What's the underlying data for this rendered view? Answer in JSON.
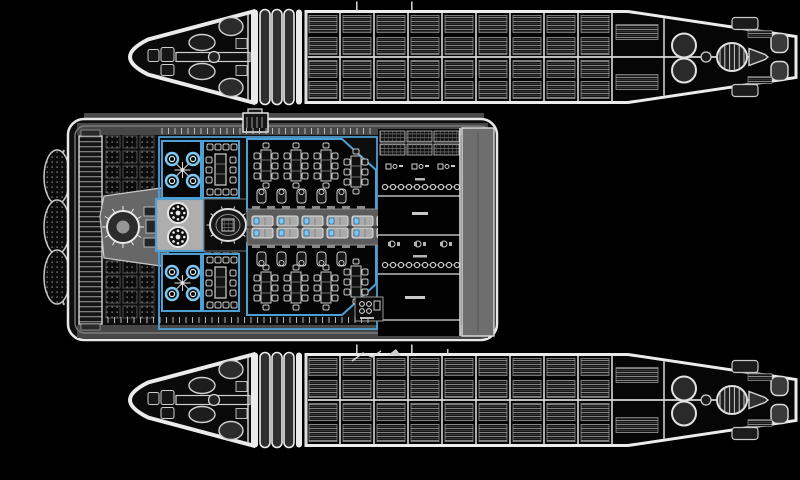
{
  "canvas": {
    "width": 800,
    "height": 480,
    "background": "#000000"
  },
  "palette": {
    "hull": "#ebebeb",
    "hull_fill": "#0a0a0a",
    "panel_gray": "#6e6e6e",
    "walkway_gray": "#474747",
    "light_gray": "#ababab",
    "line_gray": "#c9c9c9",
    "room_black": "#050505",
    "blue": "#4e9fd4",
    "blue_bright": "#7ec8f2",
    "blue_dark": "#2d6c96"
  },
  "ship": {
    "outriggers": {
      "count": 2,
      "bellows_rings": 3,
      "frame_lines": 10,
      "cargo_columns": 9,
      "cargo_rows": 4,
      "masts": 2,
      "fuel_tanks": 2,
      "positions": [
        {
          "x": 128,
          "y": 8.5
        },
        {
          "x": 128,
          "y": 351.5
        }
      ]
    },
    "main_deck": {
      "bow_dish_petals": 3,
      "cargo_grid": {
        "blocks": 2,
        "rows": 5,
        "cols": 3
      },
      "bridge": {
        "console_ticks": 12
      },
      "machine_room": {
        "gears": 2,
        "gear_teeth": 8
      },
      "reactor": {
        "teeth": 10
      },
      "crew_cabins": {
        "count": 2,
        "couch_circles": 4
      },
      "table_rooms": {
        "count": 2,
        "side_chairs": 3,
        "end_chairs": 4
      },
      "mess_halls": {
        "count": 2,
        "tables": 4,
        "chairs_per_side": 3,
        "couches": 5,
        "floor_marks": 8
      },
      "corridor": {
        "bench_columns": 6,
        "bench_rows": 2
      },
      "equipment_bay": {
        "hatch_groups": 3,
        "hatch_rows": 2,
        "machine_icons_per_row": 3,
        "icon_rows": 2,
        "pellets_per_row": 10,
        "pellet_rows": 2,
        "label_dashes": 4
      },
      "dorsal_airlock": 1,
      "utility_closet": {
        "ports": 4
      }
    }
  }
}
